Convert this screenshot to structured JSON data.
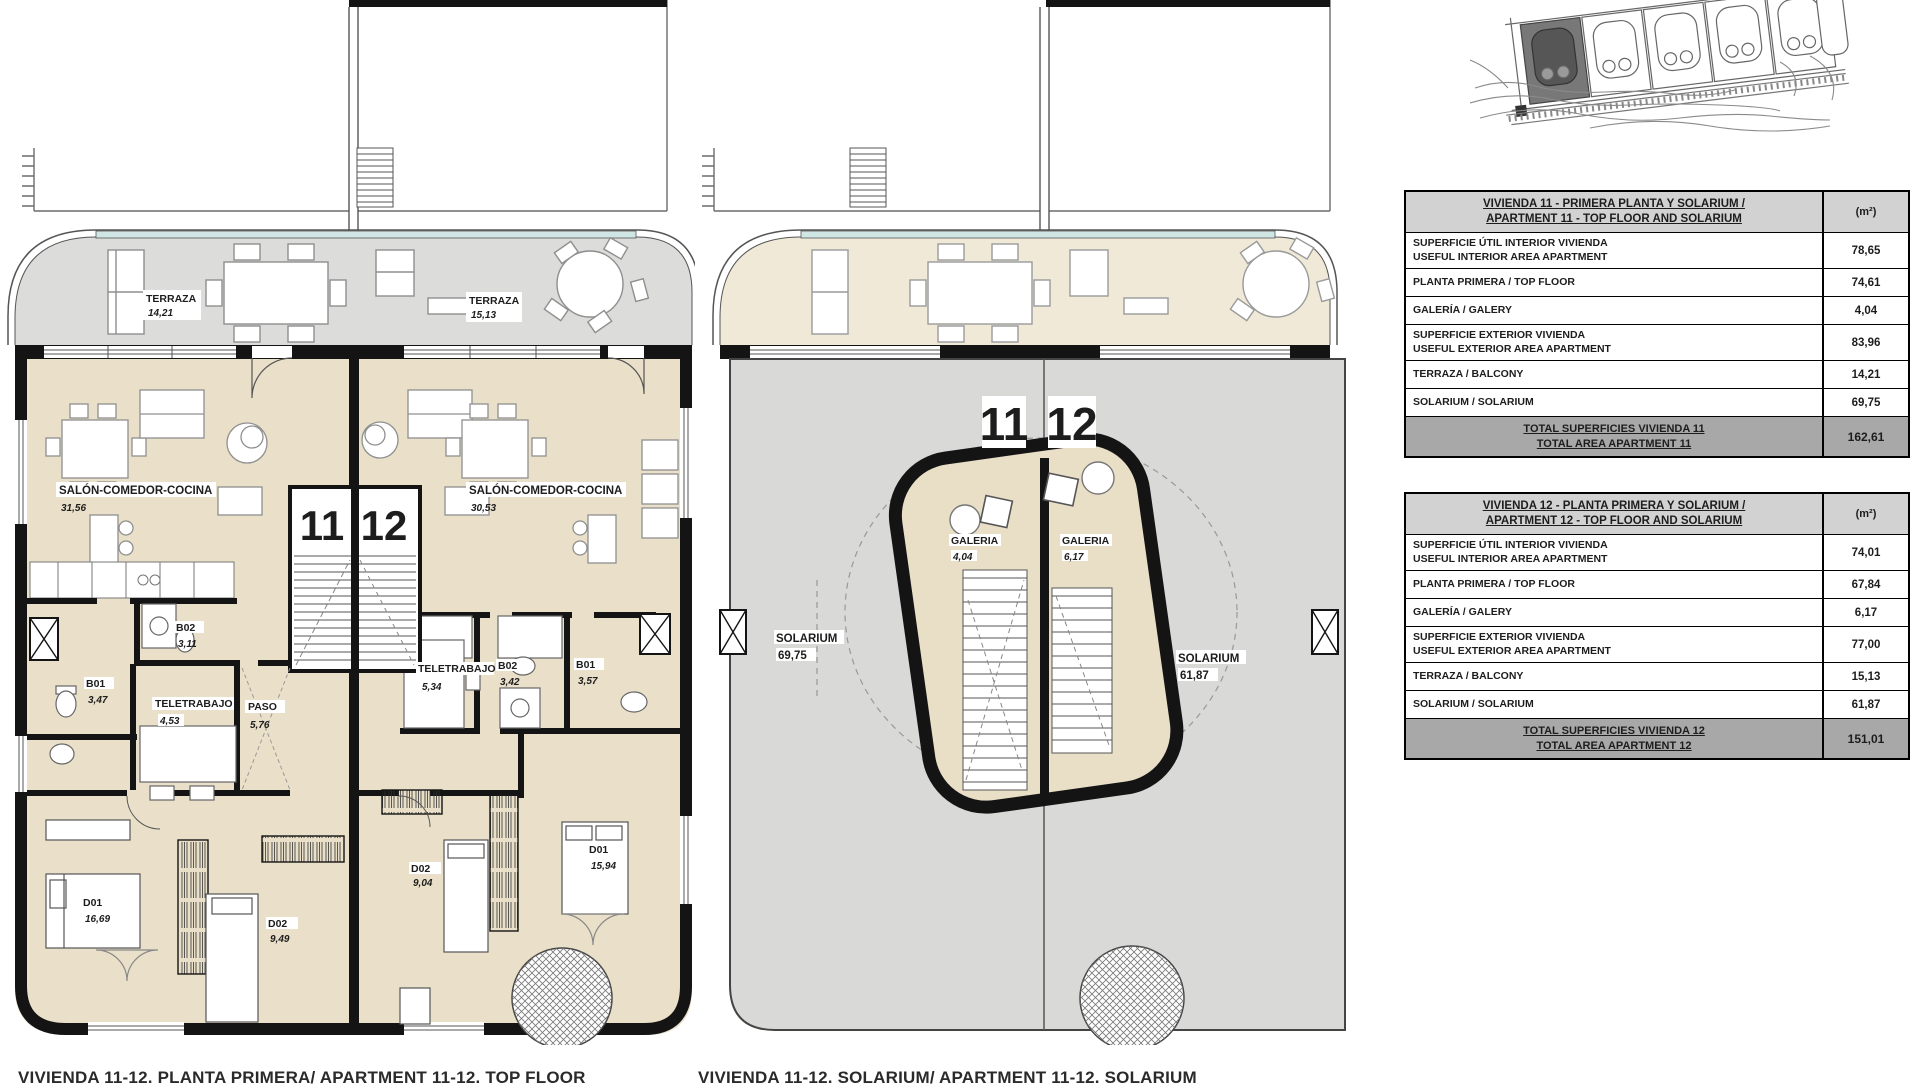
{
  "captions": {
    "top_floor": "VIVIENDA 11-12. PLANTA PRIMERA/ APARTMENT 11-12. TOP FLOOR",
    "solarium": "VIVIENDA 11-12. SOLARIUM/ APARTMENT 11-12. SOLARIUM"
  },
  "plan_top_floor": {
    "unit_left": "11",
    "unit_right": "12",
    "rooms": {
      "terraza_11": {
        "name": "TERRAZA",
        "area": "14,21"
      },
      "terraza_12": {
        "name": "TERRAZA",
        "area": "15,13"
      },
      "salon_11": {
        "name": "SALÓN-COMEDOR-COCINA",
        "area": "31,56"
      },
      "salon_12": {
        "name": "SALÓN-COMEDOR-COCINA",
        "area": "30,53"
      },
      "b02_11": {
        "name": "B02",
        "area": "3,11"
      },
      "b01_11": {
        "name": "B01",
        "area": "3,47"
      },
      "teletrabajo_11": {
        "name": "TELETRABAJO",
        "area": "4,53"
      },
      "paso_11": {
        "name": "PASO",
        "area": "5,76"
      },
      "teletrabajo_12": {
        "name": "TELETRABAJO",
        "area": "5,34"
      },
      "b02_12": {
        "name": "B02",
        "area": "3,42"
      },
      "b01_12": {
        "name": "B01",
        "area": "3,57"
      },
      "d01_11": {
        "name": "D01",
        "area": "16,69"
      },
      "d02_11": {
        "name": "D02",
        "area": "9,49"
      },
      "d02_12": {
        "name": "D02",
        "area": "9,04"
      },
      "d01_12": {
        "name": "D01",
        "area": "15,94"
      }
    }
  },
  "plan_solarium": {
    "unit_left": "11",
    "unit_right": "12",
    "rooms": {
      "galeria_11": {
        "name": "GALERIA",
        "area": "4,04"
      },
      "galeria_12": {
        "name": "GALERIA",
        "area": "6,17"
      },
      "solarium_11": {
        "name": "SOLARIUM",
        "area": "69,75"
      },
      "solarium_12": {
        "name": "SOLARIUM",
        "area": "61,87"
      }
    }
  },
  "colors": {
    "interior_beige": "#eae0c9",
    "terrace_gray": "#dcdcda",
    "terrace_beige": "#f0e9d8",
    "slab_gray": "#d9d9d7",
    "wall_black": "#141414",
    "glass_teal": "#cfe6e4",
    "table_header_gray": "#d2d2d2",
    "table_total_gray": "#a8a8a8"
  },
  "tables": [
    {
      "title_line1": "VIVIENDA 11 - PRIMERA PLANTA Y SOLARIUM /",
      "title_line2": "APARTMENT 11 - TOP FLOOR AND SOLARIUM",
      "unit_header": "(m²)",
      "rows": [
        {
          "label_line1": "SUPERFICIE ÚTIL INTERIOR VIVIENDA",
          "label_line2": "USEFUL INTERIOR AREA APARTMENT",
          "value": "78,65"
        },
        {
          "label_line1": "PLANTA PRIMERA / TOP FLOOR",
          "label_line2": "",
          "value": "74,61"
        },
        {
          "label_line1": "GALERÍA / GALERY",
          "label_line2": "",
          "value": "4,04"
        },
        {
          "label_line1": "SUPERFICIE EXTERIOR VIVIENDA",
          "label_line2": "USEFUL EXTERIOR AREA APARTMENT",
          "value": "83,96"
        },
        {
          "label_line1": "TERRAZA / BALCONY",
          "label_line2": "",
          "value": "14,21"
        },
        {
          "label_line1": "SOLARIUM / SOLARIUM",
          "label_line2": "",
          "value": "69,75"
        }
      ],
      "total_line1": "TOTAL SUPERFICIES VIVIENDA 11",
      "total_line2": "TOTAL AREA APARTMENT 11",
      "total_value": "162,61"
    },
    {
      "title_line1": "VIVIENDA 12 - PLANTA PRIMERA Y SOLARIUM /",
      "title_line2": "APARTMENT 12 - TOP FLOOR AND SOLARIUM",
      "unit_header": "(m²)",
      "rows": [
        {
          "label_line1": "SUPERFICIE ÚTIL INTERIOR VIVIENDA",
          "label_line2": "USEFUL INTERIOR AREA APARTMENT",
          "value": "74,01"
        },
        {
          "label_line1": "PLANTA PRIMERA / TOP FLOOR",
          "label_line2": "",
          "value": "67,84"
        },
        {
          "label_line1": "GALERÍA / GALERY",
          "label_line2": "",
          "value": "6,17"
        },
        {
          "label_line1": "SUPERFICIE EXTERIOR VIVIENDA",
          "label_line2": "USEFUL EXTERIOR AREA APARTMENT",
          "value": "77,00"
        },
        {
          "label_line1": "TERRAZA / BALCONY",
          "label_line2": "",
          "value": "15,13"
        },
        {
          "label_line1": "SOLARIUM / SOLARIUM",
          "label_line2": "",
          "value": "61,87"
        }
      ],
      "total_line1": "TOTAL SUPERFICIES VIVIENDA 12",
      "total_line2": "TOTAL AREA APARTMENT 12",
      "total_value": "151,01"
    }
  ]
}
